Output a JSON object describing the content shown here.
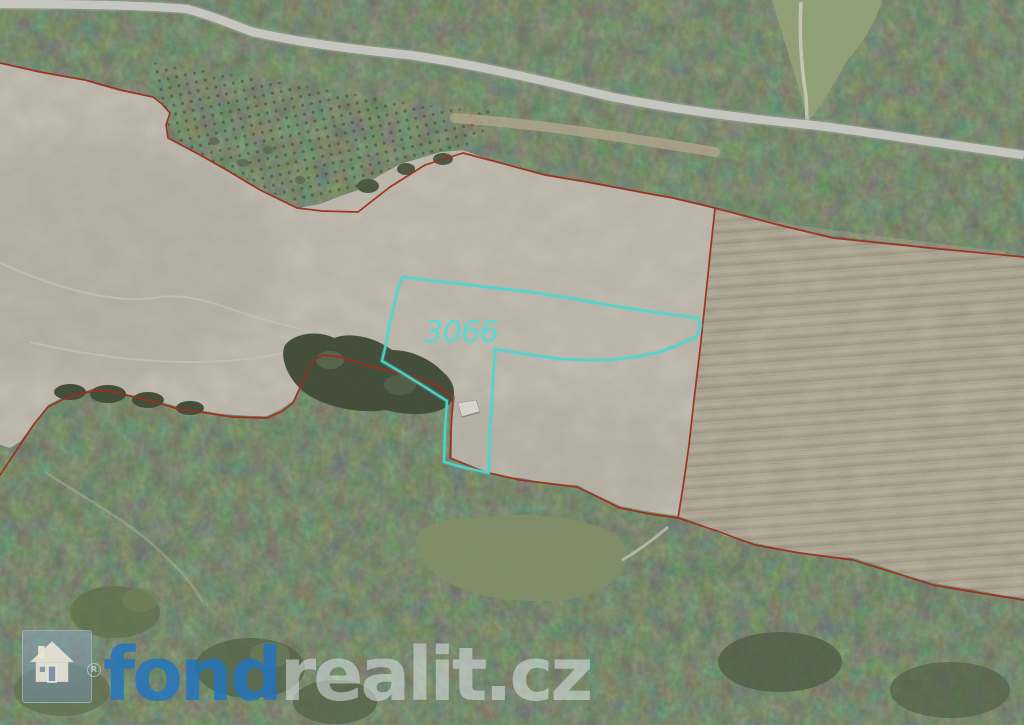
{
  "map": {
    "parcel": {
      "label": "3066",
      "label_color": "#5bd8d0",
      "outline_color": "#4fd4cc",
      "outline_points": "402,277 470,285 530,292 575,299 620,307 660,313 698,318 701,326 697,336 676,346 660,352 635,357 610,360 585,360 560,359 525,354 495,349 493,380 492,400 490,430 489,473 466,468 444,462 445,430 447,401 425,387 404,374 382,361 386,344 390,322 395,302 398,288 402,277"
    },
    "boundaries": {
      "color": "#9e2d1d",
      "paths": [
        "0,63 40,72 85,80 120,90 153,97 162,104 170,113 166,125 168,138 200,155 230,172 260,190 297,208 322,211 358,212 390,187 425,165 463,153 497,162 545,175 587,182 645,193 673,198 715,208 775,224 833,238 930,248 1024,257",
        "715,208 710,255 705,303 700,350 694,400 689,445 683,487 678,518",
        "0,475 20,445 34,424 48,407 62,400 77,395 97,390 113,392 130,396 147,400 175,408 200,412 233,417 267,418 281,412 293,403 303,381 313,360 323,355 340,357 360,363 377,368 407,375 437,385 453,398 451,430 450,458 485,472 520,480 553,484 577,487 600,498 620,508 650,514 678,518 717,531 755,545 800,553 853,560 895,573 933,585 980,593 1024,600"
      ]
    }
  },
  "watermark": {
    "icon": "house-icon",
    "brand_primary": "fond",
    "brand_secondary": "realit.cz",
    "primary_color": "rgba(33,116,192,0.82)",
    "secondary_color": "rgba(228,233,238,0.52)",
    "registered_mark": "R"
  }
}
